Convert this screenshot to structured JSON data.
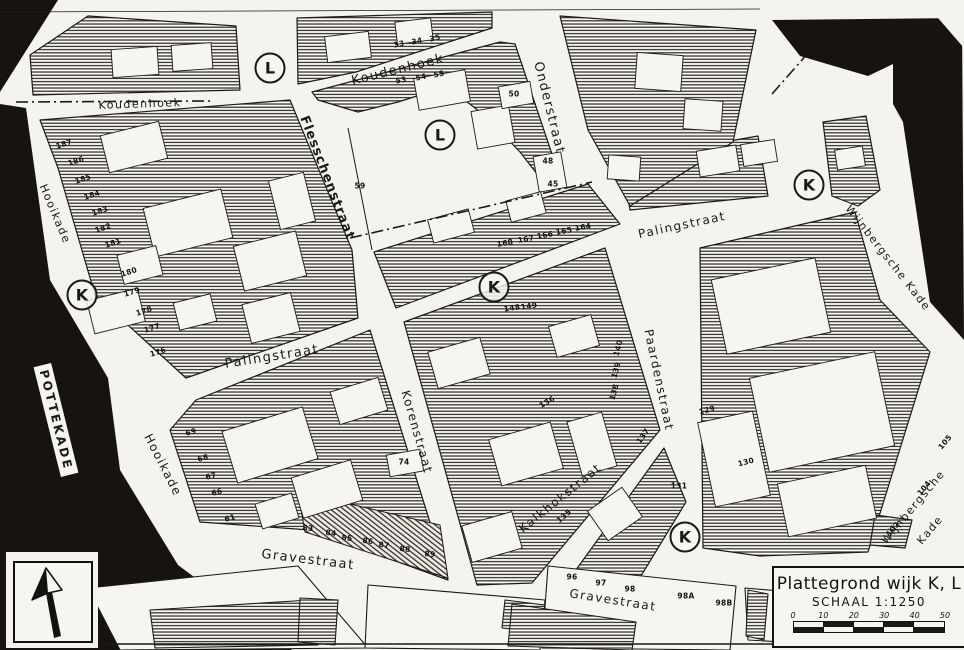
{
  "map": {
    "colors": {
      "paper": "#f7f5f0",
      "ink": "#1b1916",
      "water": "#17140f"
    },
    "title_box": {
      "title": "Plattegrond wijk K, L",
      "scale_label": "SCHAAL 1:1250",
      "scale_ticks": [
        "0",
        "10",
        "20",
        "30",
        "40",
        "50"
      ]
    },
    "street_labels": [
      {
        "text": "Koudenhoek",
        "x": 140,
        "y": 104,
        "rot": -2,
        "fs": 11
      },
      {
        "text": "Koudenhoek",
        "x": 398,
        "y": 70,
        "rot": -14,
        "fs": 13
      },
      {
        "text": "Onderstraat",
        "x": 549,
        "y": 108,
        "rot": 76,
        "fs": 13
      },
      {
        "text": "Flesschenstraat",
        "x": 327,
        "y": 178,
        "rot": 69,
        "fs": 13,
        "bold": true
      },
      {
        "text": "Palingstraat",
        "x": 272,
        "y": 357,
        "rot": -9,
        "fs": 13
      },
      {
        "text": "Palingstraat",
        "x": 682,
        "y": 225,
        "rot": -12,
        "fs": 12
      },
      {
        "text": "Korenstraat",
        "x": 417,
        "y": 432,
        "rot": 74,
        "fs": 12
      },
      {
        "text": "Paardenstraat",
        "x": 659,
        "y": 380,
        "rot": 78,
        "fs": 12
      },
      {
        "text": "Kalkhokstraat",
        "x": 560,
        "y": 498,
        "rot": -39,
        "fs": 12
      },
      {
        "text": "Gravestraat",
        "x": 308,
        "y": 560,
        "rot": 7,
        "fs": 13
      },
      {
        "text": "Gravestraat",
        "x": 613,
        "y": 600,
        "rot": 9,
        "fs": 12
      },
      {
        "text": "Hooikade",
        "x": 55,
        "y": 214,
        "rot": 67,
        "fs": 11
      },
      {
        "text": "Hooikade",
        "x": 163,
        "y": 465,
        "rot": 63,
        "fs": 12
      },
      {
        "text": "Wijnbergsche Kade",
        "x": 888,
        "y": 258,
        "rot": 52,
        "fs": 11
      },
      {
        "text": "Wijnbergsche",
        "x": 913,
        "y": 507,
        "rot": -50,
        "fs": 11
      },
      {
        "text": "Kade",
        "x": 930,
        "y": 530,
        "rot": -50,
        "fs": 11
      },
      {
        "text": "POTTEKADE",
        "x": 56,
        "y": 420,
        "rot": 76,
        "fs": 12,
        "boxed": true
      }
    ],
    "district_markers": [
      {
        "letter": "L",
        "x": 270,
        "y": 68
      },
      {
        "letter": "L",
        "x": 440,
        "y": 135
      },
      {
        "letter": "K",
        "x": 809,
        "y": 185
      },
      {
        "letter": "K",
        "x": 82,
        "y": 295
      },
      {
        "letter": "K",
        "x": 494,
        "y": 287
      },
      {
        "letter": "K",
        "x": 685,
        "y": 537
      }
    ],
    "house_numbers": [
      {
        "t": "187",
        "x": 64,
        "y": 144,
        "r": -18
      },
      {
        "t": "186",
        "x": 76,
        "y": 161,
        "r": -18
      },
      {
        "t": "185",
        "x": 83,
        "y": 179,
        "r": -18
      },
      {
        "t": "184",
        "x": 92,
        "y": 195,
        "r": -18
      },
      {
        "t": "183",
        "x": 100,
        "y": 211,
        "r": -18
      },
      {
        "t": "182",
        "x": 103,
        "y": 228,
        "r": -18
      },
      {
        "t": "181",
        "x": 113,
        "y": 243,
        "r": -18
      },
      {
        "t": "180",
        "x": 129,
        "y": 272,
        "r": -18
      },
      {
        "t": "179",
        "x": 132,
        "y": 292,
        "r": -18
      },
      {
        "t": "178",
        "x": 144,
        "y": 311,
        "r": -18
      },
      {
        "t": "177",
        "x": 152,
        "y": 328,
        "r": -18
      },
      {
        "t": "176",
        "x": 158,
        "y": 352,
        "r": -18
      },
      {
        "t": "69",
        "x": 191,
        "y": 432,
        "r": -15
      },
      {
        "t": "68",
        "x": 203,
        "y": 458,
        "r": -15
      },
      {
        "t": "67",
        "x": 211,
        "y": 476,
        "r": -15
      },
      {
        "t": "66",
        "x": 217,
        "y": 492,
        "r": -15
      },
      {
        "t": "61",
        "x": 230,
        "y": 518,
        "r": -15
      },
      {
        "t": "59",
        "x": 360,
        "y": 186,
        "r": 0
      },
      {
        "t": "74",
        "x": 404,
        "y": 462,
        "r": 0
      },
      {
        "t": "33",
        "x": 399,
        "y": 44,
        "r": -12
      },
      {
        "t": "34",
        "x": 417,
        "y": 41,
        "r": -12
      },
      {
        "t": "35",
        "x": 435,
        "y": 38,
        "r": -12
      },
      {
        "t": "53",
        "x": 401,
        "y": 80,
        "r": -12
      },
      {
        "t": "54",
        "x": 421,
        "y": 77,
        "r": -12
      },
      {
        "t": "55",
        "x": 439,
        "y": 74,
        "r": -12
      },
      {
        "t": "50",
        "x": 514,
        "y": 94,
        "r": 0
      },
      {
        "t": "48",
        "x": 548,
        "y": 161,
        "r": 0
      },
      {
        "t": "45",
        "x": 553,
        "y": 184,
        "r": 0
      },
      {
        "t": "168",
        "x": 505,
        "y": 243,
        "r": -10
      },
      {
        "t": "167",
        "x": 526,
        "y": 239,
        "r": -10
      },
      {
        "t": "166",
        "x": 545,
        "y": 235,
        "r": -10
      },
      {
        "t": "165",
        "x": 564,
        "y": 231,
        "r": -10
      },
      {
        "t": "164",
        "x": 583,
        "y": 227,
        "r": -10
      },
      {
        "t": "148",
        "x": 512,
        "y": 308,
        "r": -8
      },
      {
        "t": "149",
        "x": 529,
        "y": 306,
        "r": -8
      },
      {
        "t": "140",
        "x": 618,
        "y": 348,
        "r": -75
      },
      {
        "t": "139",
        "x": 616,
        "y": 370,
        "r": -75
      },
      {
        "t": "138",
        "x": 614,
        "y": 392,
        "r": -75
      },
      {
        "t": "136",
        "x": 547,
        "y": 402,
        "r": -30
      },
      {
        "t": "137",
        "x": 643,
        "y": 436,
        "r": -55
      },
      {
        "t": "135",
        "x": 564,
        "y": 516,
        "r": -40
      },
      {
        "t": "131",
        "x": 679,
        "y": 486,
        "r": 0
      },
      {
        "t": "83",
        "x": 308,
        "y": 528,
        "r": 6
      },
      {
        "t": "84",
        "x": 331,
        "y": 533,
        "r": 6
      },
      {
        "t": "85",
        "x": 347,
        "y": 538,
        "r": 6
      },
      {
        "t": "86",
        "x": 368,
        "y": 541,
        "r": 6
      },
      {
        "t": "87",
        "x": 384,
        "y": 545,
        "r": 6
      },
      {
        "t": "88",
        "x": 405,
        "y": 549,
        "r": 6
      },
      {
        "t": "89",
        "x": 430,
        "y": 554,
        "r": 6
      },
      {
        "t": "96",
        "x": 572,
        "y": 577,
        "r": 0
      },
      {
        "t": "97",
        "x": 601,
        "y": 583,
        "r": 0
      },
      {
        "t": "98",
        "x": 630,
        "y": 589,
        "r": 0
      },
      {
        "t": "98A",
        "x": 686,
        "y": 596,
        "r": 0
      },
      {
        "t": "98B",
        "x": 724,
        "y": 603,
        "r": 0
      },
      {
        "t": "129",
        "x": 707,
        "y": 410,
        "r": -15
      },
      {
        "t": "130",
        "x": 746,
        "y": 462,
        "r": -15
      },
      {
        "t": "102",
        "x": 893,
        "y": 529,
        "r": -50
      },
      {
        "t": "104",
        "x": 924,
        "y": 488,
        "r": -50
      },
      {
        "t": "105",
        "x": 945,
        "y": 442,
        "r": -50
      }
    ]
  }
}
